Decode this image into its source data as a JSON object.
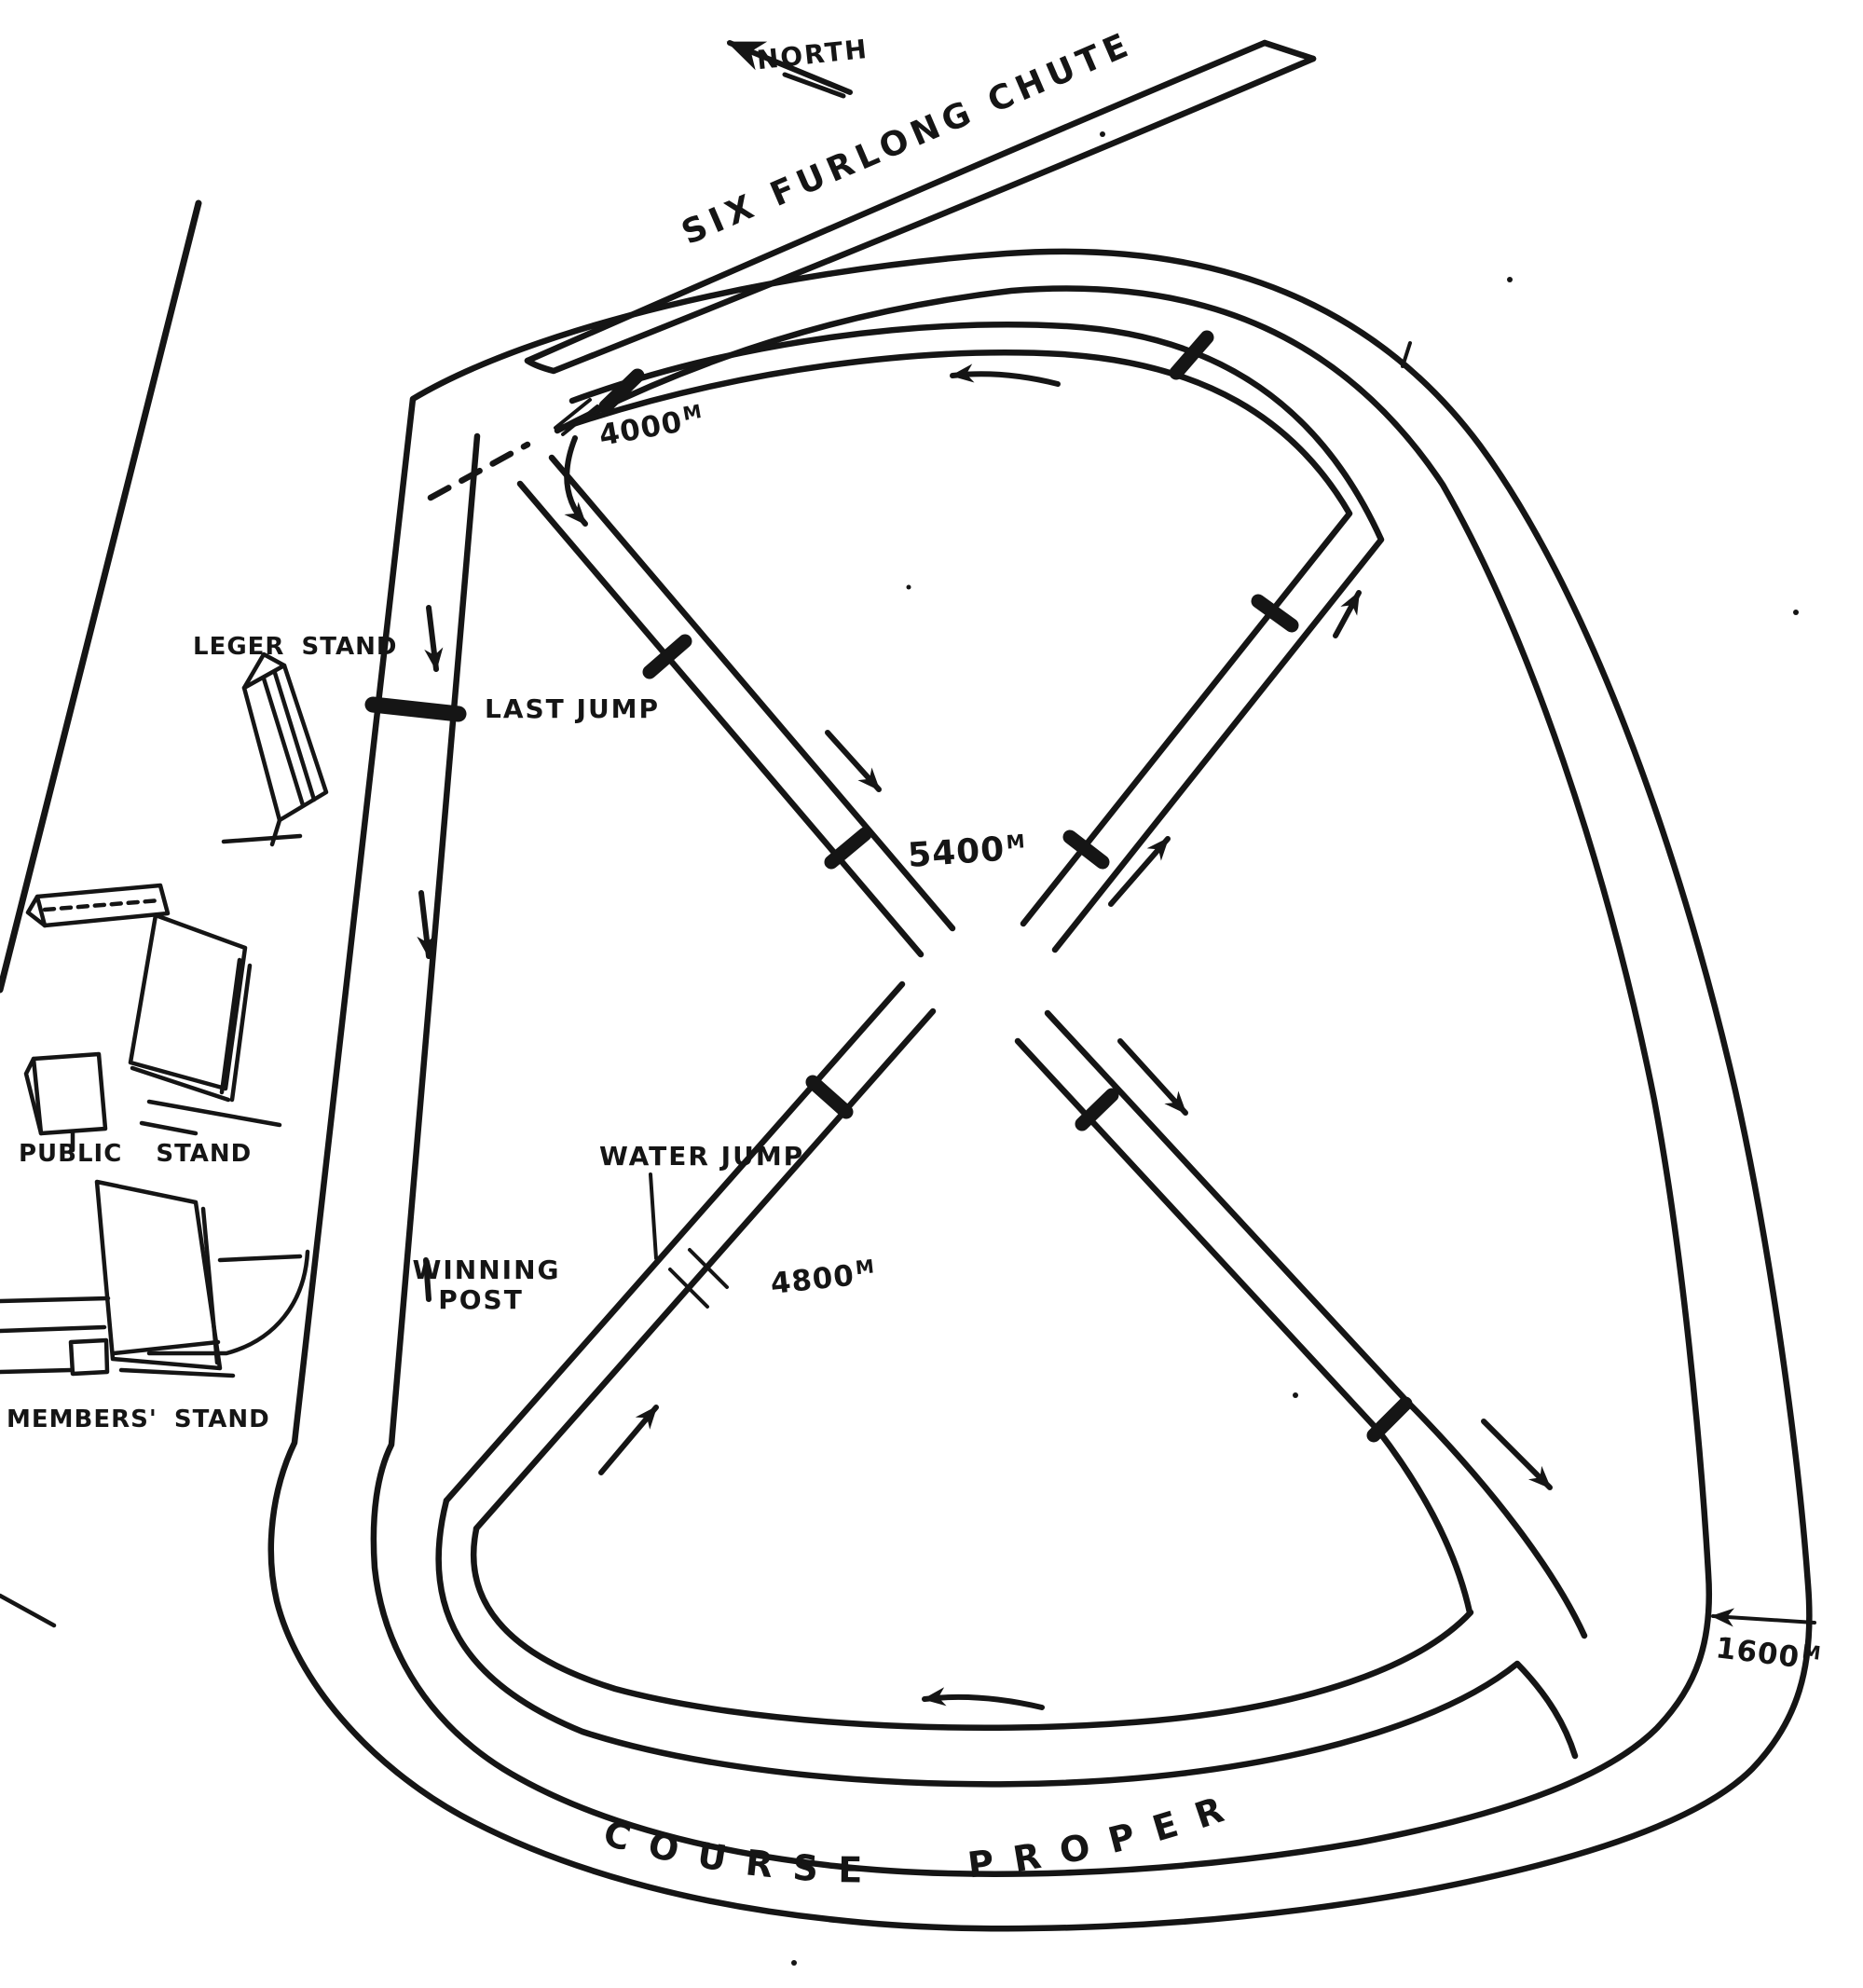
{
  "page": {
    "background": "#ffffff",
    "ink": "#151515"
  },
  "compass": {
    "label": "NORTH"
  },
  "chute": {
    "label": "SIX FURLONG CHUTE"
  },
  "course_proper": {
    "label": "COURSE PROPER"
  },
  "distance_markers": {
    "m4000": {
      "value": "4000",
      "unit": "M"
    },
    "m5400": {
      "value": "5400",
      "unit": "M"
    },
    "m4800": {
      "value": "4800",
      "unit": "M"
    },
    "m1600": {
      "value": "1600",
      "unit": "M"
    }
  },
  "course_features": {
    "last_jump": "LAST JUMP",
    "water_jump": "WATER JUMP",
    "winning_post_line1": "WINNING",
    "winning_post_line2": "POST"
  },
  "stands": {
    "leger": "LEGER STAND",
    "public": "PUBLIC STAND",
    "members": "MEMBERS' STAND"
  }
}
